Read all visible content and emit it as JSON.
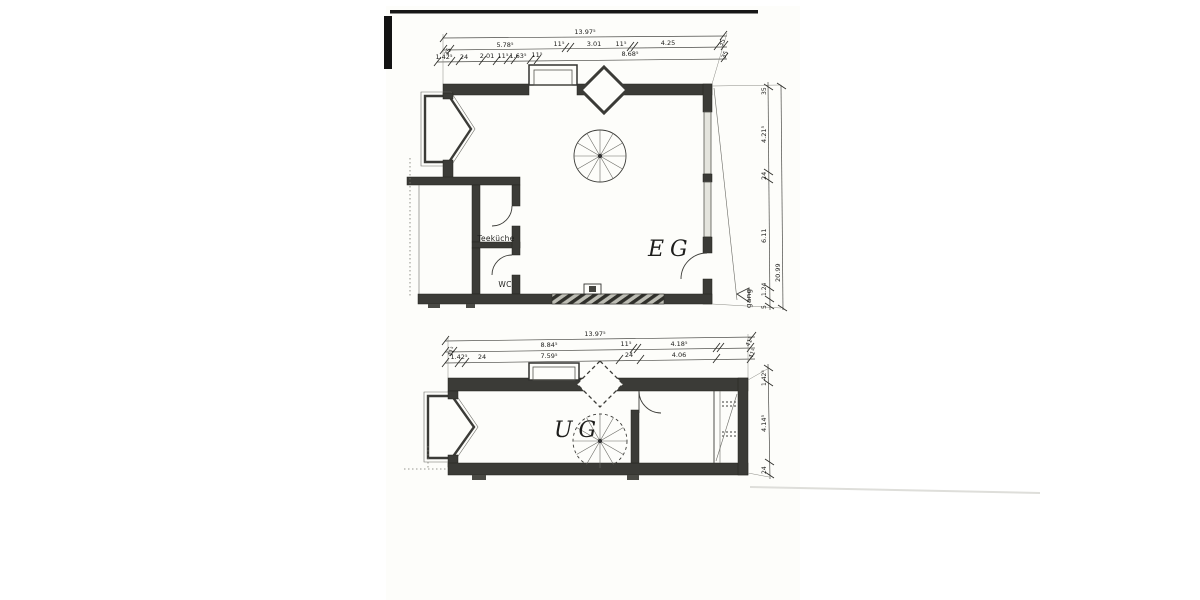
{
  "plans": {
    "eg": {
      "name": "EG",
      "rooms": {
        "teekueche": "Teeküche",
        "wc": "WC"
      },
      "gang": "gang",
      "dims": {
        "total": "13.97⁵",
        "row1": [
          "35",
          "5.78⁵",
          "11⁵",
          "3.01",
          "11⁵",
          "4.25",
          "35"
        ],
        "row2": [
          "1.42⁵",
          "24",
          "2.01",
          "11⁵",
          "1.63⁵",
          "11⁵",
          "8.68⁵",
          "35"
        ],
        "right_col": [
          "35",
          "4.21⁵",
          "24",
          "6.11",
          "1.24",
          "5"
        ],
        "right_total": "20.99"
      }
    },
    "ug": {
      "name": "UG",
      "dims": {
        "total": "13.97⁵",
        "row1": [
          "41⁵",
          "8.84⁵",
          "11⁵",
          "4.18⁵",
          "41⁵"
        ],
        "row2": [
          "1.42⁵",
          "24",
          "7.59⁵",
          "24",
          "4.06",
          "41⁵"
        ],
        "right_col": [
          "1.42⁵",
          "4.14⁵",
          "24"
        ]
      }
    }
  }
}
